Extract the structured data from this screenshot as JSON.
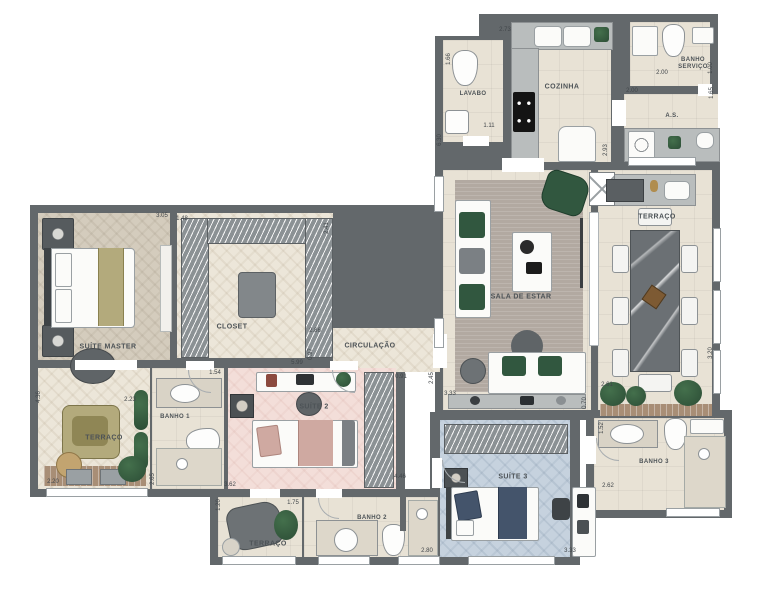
{
  "plan_title": "Apartment floor plan",
  "colors": {
    "wall": "#63686b",
    "floorBeige": "#e8e2d5",
    "floorHer": "#ece6d9",
    "floorMaster": "#d4ccbd",
    "floorPink": "#f3ded9",
    "floorBlue": "#c6d2de",
    "rug": "#b2a9a1",
    "counter": "#b9bdbd",
    "marble": "#6b7074",
    "olive": "#b3aa7c",
    "accentGreen": "#31573f",
    "rose": "#cfa9a1",
    "navy": "#44546b"
  },
  "rooms": {
    "suite_master": {
      "label": "SUÍTE MASTER"
    },
    "closet": {
      "label": "CLOSET"
    },
    "circulacao": {
      "label": "CIRCULAÇÃO"
    },
    "terraco_left": {
      "label": "TERRAÇO"
    },
    "banho1": {
      "label": "BANHO 1"
    },
    "suite2": {
      "label": "SUÍTE 2"
    },
    "terraco_bottom": {
      "label": "TERRAÇO"
    },
    "banho2": {
      "label": "BANHO 2"
    },
    "suite3": {
      "label": "SUÍTE 3"
    },
    "banho3": {
      "label": "BANHO 3"
    },
    "sala": {
      "label": "SALA DE ESTAR"
    },
    "terraco_right": {
      "label": "TERRAÇO"
    },
    "cozinha": {
      "label": "COZINHA"
    },
    "lavabo": {
      "label": "LAVABO"
    },
    "banho_servico": {
      "label": "BANHO SERVIÇO"
    },
    "as": {
      "label": "A.S."
    }
  },
  "dims": {
    "d1": "2.73",
    "d2": "1.66",
    "d3": "1.11",
    "d4": "6.30",
    "d5": "2.00",
    "d6": "2.00",
    "d7": "1.00",
    "d8": "1.65",
    "d9": "2.93",
    "d10": "3.05",
    "d11": "1.48",
    "d12": "2.41",
    "d13": "2.86",
    "d14": "5.99",
    "d15": "0.97",
    "d16": "0.91",
    "d17": "2.45",
    "d18": "3.33",
    "d19": "0.70",
    "d20": "2.61",
    "d21": "3.20",
    "d22": "1.54",
    "d23": "2.23",
    "d24": "4.36",
    "d25": "2.20",
    "d26": "2.65",
    "d27": "3.62",
    "d28": "1.75",
    "d29": "1.20",
    "d30": "4.46",
    "d31": "1.52",
    "d32": "2.62",
    "d33": "2.80",
    "d34": "3.33"
  }
}
